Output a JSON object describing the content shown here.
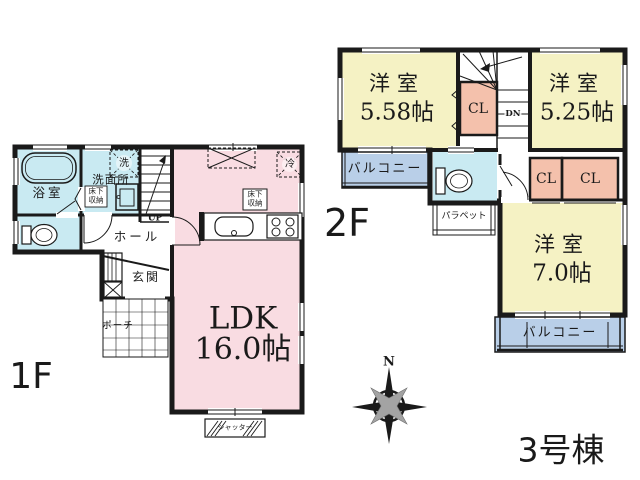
{
  "building_label": "3号棟",
  "compass": {
    "north_label": "N"
  },
  "floor1": {
    "floor_label": "1F",
    "bath_label": "浴室",
    "washroom_label": "洗面所",
    "washer_label": "洗",
    "underfloor_washroom_label": "床下収納",
    "stairs_up_label": "UP",
    "hall_label": "ホール",
    "entrance_label": "玄関",
    "porch_label": "ポーチ",
    "ldk_label": "LDK",
    "ldk_size_label": "16.0帖",
    "underfloor_ldk_label": "床下収納",
    "fridge_label": "冷",
    "shutter_label": "シャッター"
  },
  "floor2": {
    "floor_label": "2F",
    "bedroom1_label": "洋室",
    "bedroom1_size_label": "5.58帖",
    "bedroom2_label": "洋室",
    "bedroom2_size_label": "5.25帖",
    "bedroom3_label": "洋室",
    "bedroom3_size_label": "7.0帖",
    "closet_stair_label": "CL",
    "closet_a_label": "CL",
    "closet_b_label": "CL",
    "stairs_down_label": "DN",
    "balcony_west_label": "バルコニー",
    "balcony_south_label": "バルコニー",
    "parapet_label": "パラペット"
  },
  "colors": {
    "ldk_fill": "#f9dce2",
    "bedroom_fill": "#f5f2c4",
    "wet_area_fill": "#c9eaf2",
    "closet_fill": "#f4c1ac",
    "balcony_fill": "#b9cfe8",
    "wall": "#1a1a1a"
  }
}
